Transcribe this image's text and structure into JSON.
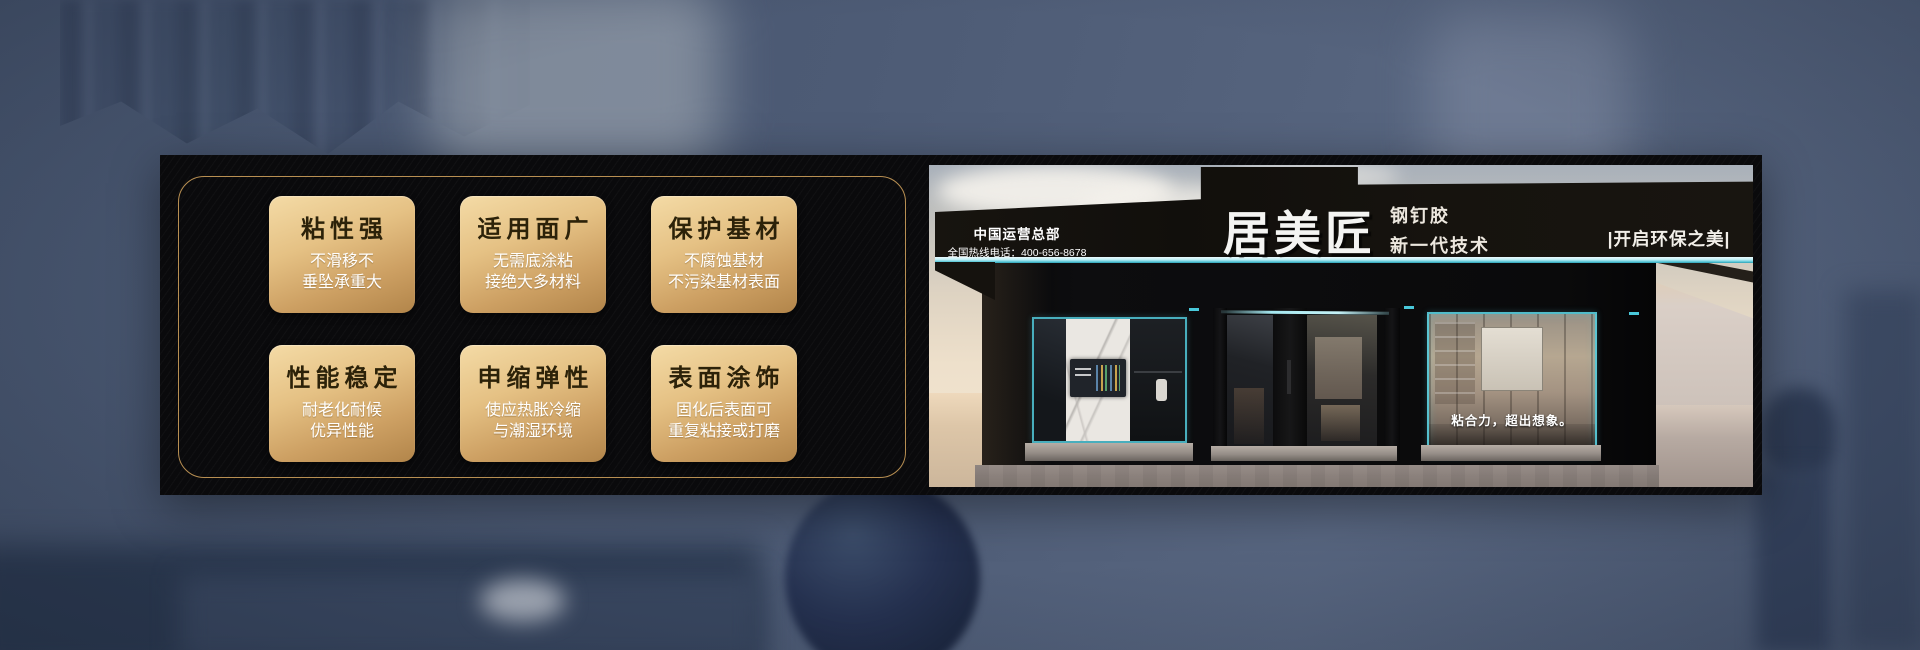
{
  "panel": {
    "cards": [
      {
        "title": "粘性强",
        "lines": [
          "不滑移不",
          "垂坠承重大"
        ]
      },
      {
        "title": "适用面广",
        "lines": [
          "无需底涂粘",
          "接绝大多材料"
        ]
      },
      {
        "title": "保护基材",
        "lines": [
          "不腐蚀基材",
          "不污染基材表面"
        ]
      },
      {
        "title": "性能稳定",
        "lines": [
          "耐老化耐候",
          "优异性能"
        ]
      },
      {
        "title": "申缩弹性",
        "lines": [
          "使应热胀冷缩",
          "与潮湿环境"
        ]
      },
      {
        "title": "表面涂饰",
        "lines": [
          "固化后表面可",
          "重复粘接或打磨"
        ]
      }
    ],
    "colors": {
      "frame_gold": "#b88f52",
      "card_gold_light": "#f4dba6",
      "card_gold_dark": "#b2854a",
      "title_text": "#2c2209",
      "subtitle_text": "#ffffff",
      "panel_black": "#0a0a0c"
    }
  },
  "storefront": {
    "operations_hq": "中国运营总部",
    "hotline": "全国热线电话：400-656-8678",
    "brand": "居美匠",
    "product": "钢钉胶",
    "tagline": "新一代技术",
    "eco_slogan": "|开启环保之美|",
    "window_slogan": "粘合力，超出想象。",
    "colors": {
      "light_strip": "#bdeef5",
      "window_frame_cyan": "#49c8da",
      "sign_black": "#16130f"
    }
  }
}
